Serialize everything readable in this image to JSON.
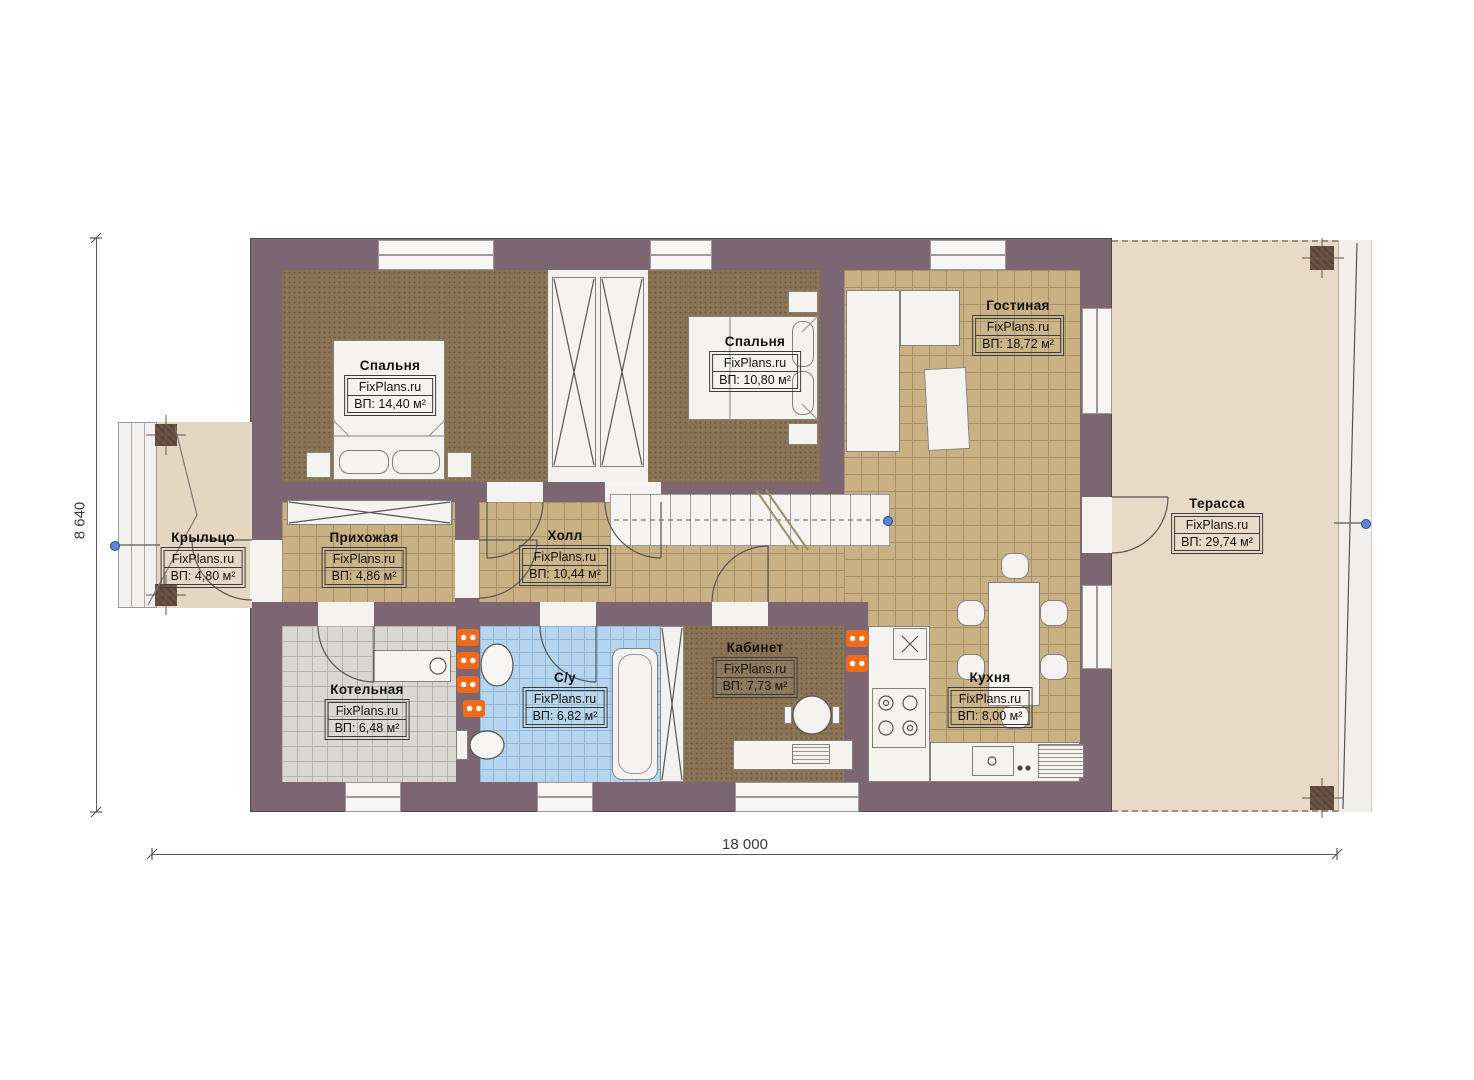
{
  "brand": "FixPlans.ru",
  "dimensions": {
    "horizontal": "18 000",
    "vertical": "8 640"
  },
  "rooms": [
    {
      "id": "bedroom-1",
      "name": "Спальня",
      "area": "ВП: 14,40 м²"
    },
    {
      "id": "bedroom-2",
      "name": "Спальня",
      "area": "ВП: 10,80 м²"
    },
    {
      "id": "living-room",
      "name": "Гостиная",
      "area": "ВП: 18,72 м²"
    },
    {
      "id": "porch",
      "name": "Крыльцо",
      "area": "ВП: 4,80 м²"
    },
    {
      "id": "hallway",
      "name": "Прихожая",
      "area": "ВП: 4,86 м²"
    },
    {
      "id": "hall",
      "name": "Холл",
      "area": "ВП: 10,44 м²"
    },
    {
      "id": "terrace",
      "name": "Терасса",
      "area": "ВП: 29,74 м²"
    },
    {
      "id": "boiler-room",
      "name": "Котельная",
      "area": "ВП: 6,48 м²"
    },
    {
      "id": "bathroom",
      "name": "С/у",
      "area": "ВП: 6,82 м²"
    },
    {
      "id": "office",
      "name": "Кабинет",
      "area": "ВП: 7,73 м²"
    },
    {
      "id": "kitchen",
      "name": "Кухня",
      "area": "ВП: 8,00 м²"
    }
  ],
  "colors": {
    "wall": "#7b6671",
    "bedroom_floor": "#8b7355",
    "tile_floor": "#c9b183",
    "boiler_floor": "#d8d7d3",
    "bathroom_floor": "#b5d5ee",
    "terrace_floor": "#e8dac6",
    "radiator": "#f06a1a",
    "grip": "#5b87d6"
  }
}
